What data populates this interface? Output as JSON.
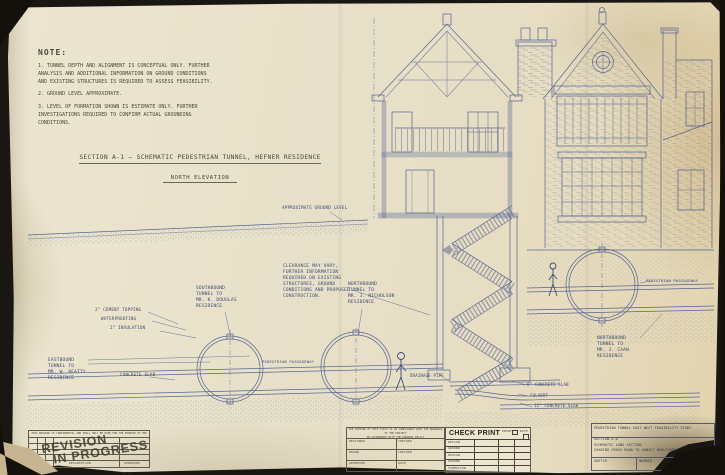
{
  "notes": {
    "title": "NOTE:",
    "items": [
      "1. TUNNEL DEPTH AND ALIGNMENT IS CONCEPTUAL ONLY. FURTHER\nANALYSIS AND ADDITIONAL INFORMATION ON GROUND CONDITIONS\nAND EXISTING STRUCTURES IS REQUIRED TO ASSESS FEASIBILITY.",
      "2. GROUND LEVEL APPROXIMATE.",
      "3. LEVEL OF FORMATION SHOWN IS ESTIMATE ONLY. FURTHER\nINVESTIGATIONS REQUIRED TO CONFIRM ACTUAL GROUNDING\nCONDITIONS."
    ]
  },
  "section": {
    "title": "SECTION A-1 — SCHEMATIC PEDESTRIAN TUNNEL, HEFNER RESIDENCE",
    "subtitle": "NORTH ELEVATION"
  },
  "annotations": {
    "ground_level": "APPROXIMATE   GROUND   LEVEL",
    "clearance": "CLEARANCE MAY VARY,\nFURTHER INFORMATION\nREQUIRED ON EXISTING\nSTRUCTURES, GROUND\nCONDITIONS AND PROPOSED\nCONSTRUCTION.",
    "southbound": "SOUTHBOUND\nTUNNEL TO\nMR. K. DOUGLAS\nRESIDENCE",
    "northbound_nicholson": "NORTHBOUND\nTUNNEL TO\nMR. J. NICHOLSON\nRESIDENCE",
    "northbound_caan": "NORTHBOUND\nTUNNEL TO\nMR. J. CAAN\nRESIDENCE",
    "eastbound": "EASTBOUND\nTUNNEL TO\nMR. W. BEATTY\nRESIDENCE",
    "cement_topping": "2\" CEMENT TOPPING",
    "waterproofing": "WATERPROOFING",
    "insulation": "2\" INSULATION",
    "concrete_slab": "CONCRETE SLAB",
    "passageway_mid": "PEDESTRIAN PASSAGEWAY",
    "passageway_right": "PEDESTRIAN PASSAGEWAY",
    "drainage_pipe": "DRAINAGE PIPE",
    "slab_6": "6\" CONCRETE SLAB",
    "culvert": "CULVERT",
    "slab_12": "12\" CONCRETE SLAB"
  },
  "stamp": {
    "line1": "REVISION",
    "line2": "IN PROGRESS"
  },
  "blocks": {
    "revision": {
      "confidential": "THIS DRAWING IS CONFIDENTIAL AND SHALL ONLY BE USED FOR THE PURPOSE OF THE PROJECT",
      "description_label": "DESCRIPTION",
      "approved_label": "APPROVED"
    },
    "signoff": {
      "notice": "THE COPYING OF THIS TITLE IS IN COMPLIANCE WITH THE DRAWINGS OF THE PROJECT\nIN ACCORDANCE WITH THE DRAWING POLICY",
      "designed": "DESIGNED",
      "checked1": "CHECKED",
      "drawn": "DRAWN",
      "checked2": "CHECKED",
      "approved": "APPROVED",
      "date": "DATE"
    },
    "check_print": {
      "title": "CHECK PRINT",
      "print_label": "PRINT",
      "date_label": "DATE",
      "rows": [
        "DESIGN",
        "GROUND",
        "DESIGN",
        "GROUND",
        "FORMATION"
      ]
    },
    "project": {
      "title": "PEDESTRIAN TUNNEL EAST WEST FEASIBILITY STUDY",
      "section": "SECTION A-A",
      "drawing": "SCHEMATIC LONG SECTION",
      "route": "CHARING CROSS ROAD TO SUNSET BOULEVARD",
      "sketch_label": "SKETCH",
      "number_label": "NUMBER"
    }
  }
}
